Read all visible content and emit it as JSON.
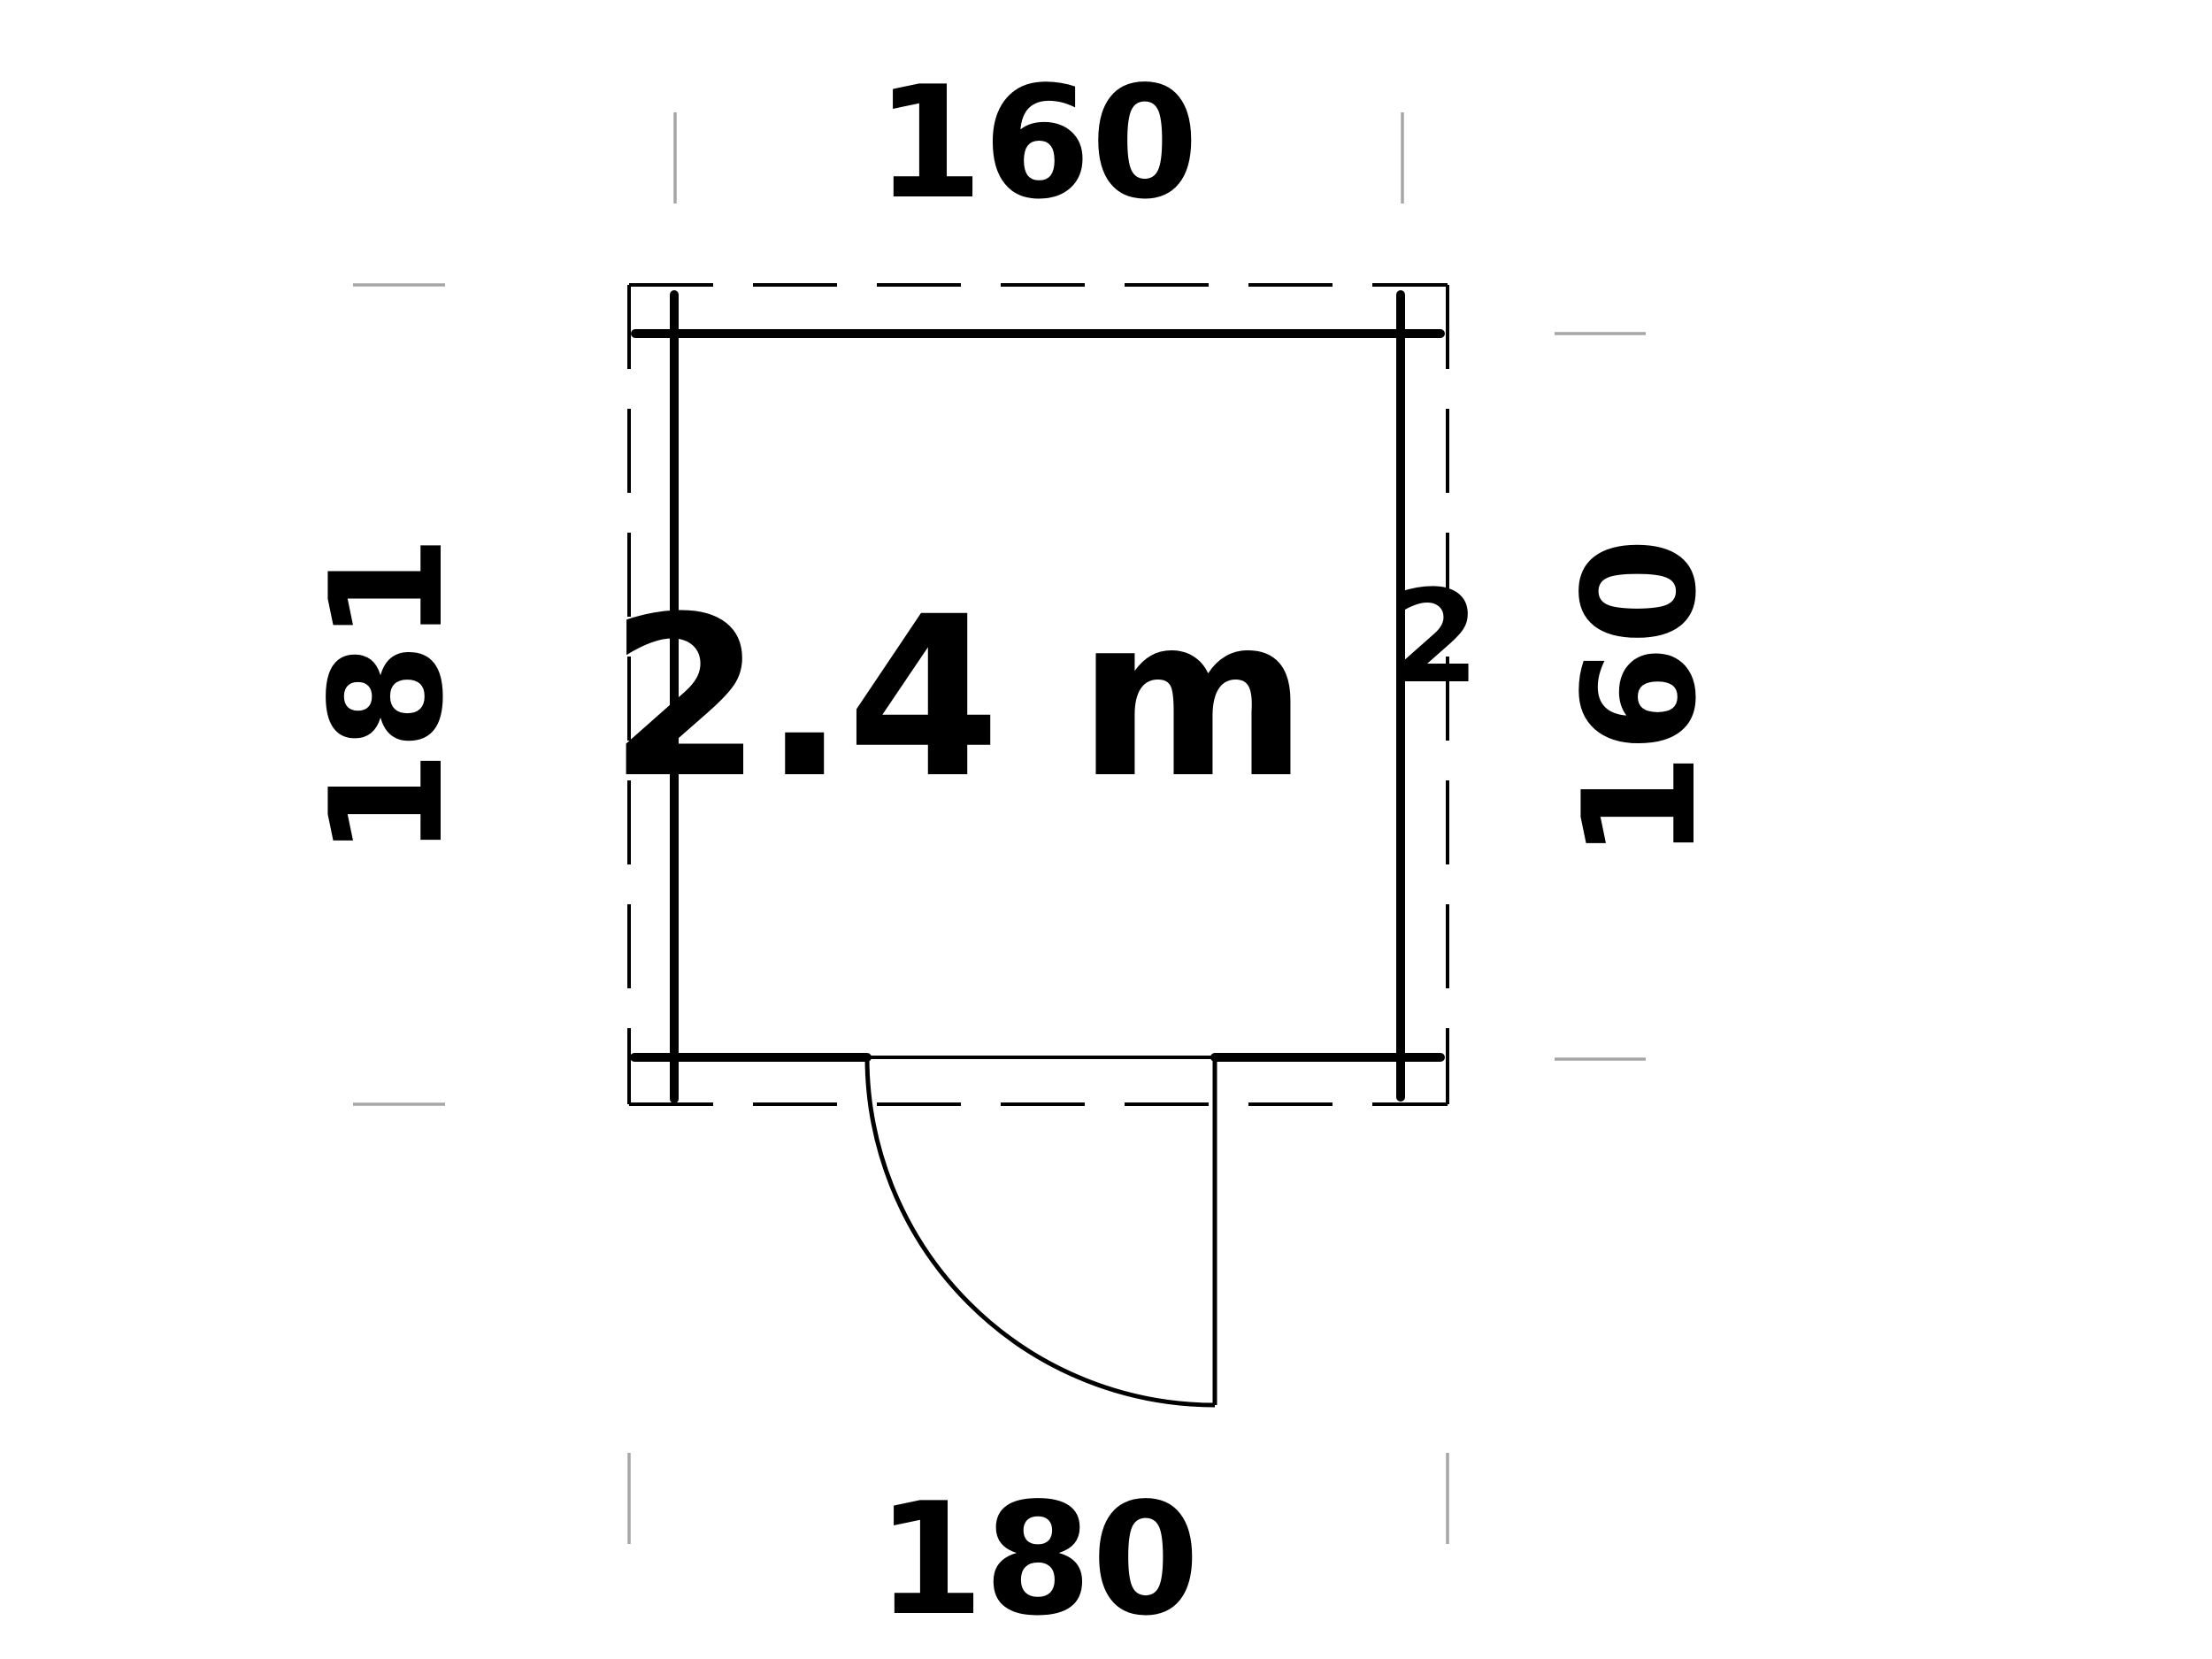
{
  "diagram": {
    "type": "floor-plan",
    "area_label": {
      "main": "2.4 m",
      "exponent": "2"
    },
    "dimensions": {
      "top": {
        "value": "160"
      },
      "right": {
        "value": "160"
      },
      "bottom": {
        "value": "180"
      },
      "left": {
        "value": "181"
      }
    },
    "colors": {
      "line": "#000000",
      "text": "#000000",
      "tick": "#a6a6a6",
      "background": "#ffffff"
    }
  }
}
